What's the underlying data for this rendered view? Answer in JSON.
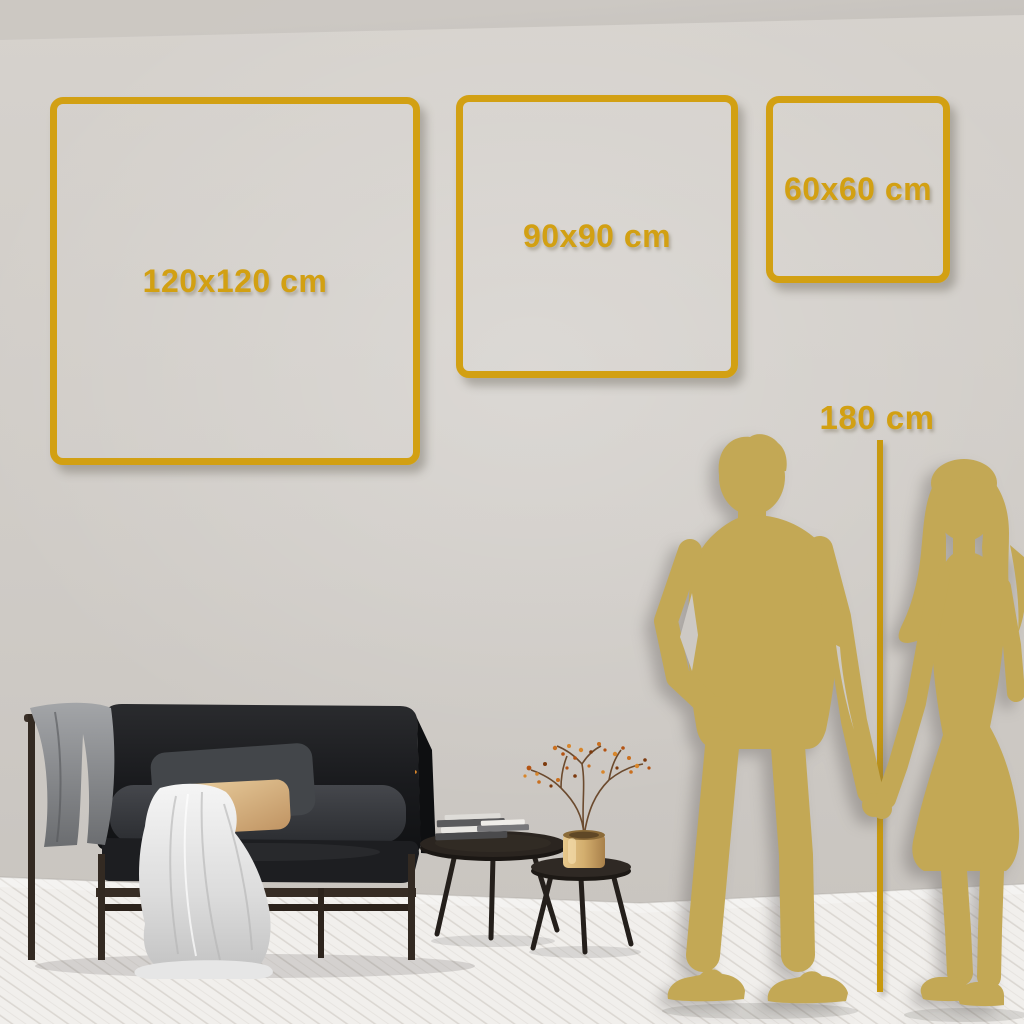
{
  "size_guide": {
    "frames": [
      {
        "label": "120x120 cm",
        "width_cm": 120,
        "height_cm": 120
      },
      {
        "label": "90x90 cm",
        "width_cm": 90,
        "height_cm": 90
      },
      {
        "label": "60x60 cm",
        "width_cm": 60,
        "height_cm": 60
      }
    ],
    "person_height": {
      "label": "180 cm",
      "height_cm": 180
    }
  },
  "colors": {
    "accent_gold": "#D2A013",
    "accent_gold_dark": "#C8990F",
    "silhouette_gold": "#C3A855",
    "wall_light": "#D6D2CD",
    "wall_dark": "#C7C3BE",
    "floor_base": "#F1EFEC",
    "floor_line": "#DBD7D2"
  },
  "scene": {
    "objects": [
      "gold-frame-120",
      "gold-frame-90",
      "gold-frame-60",
      "height-reference-line",
      "couple-silhouette",
      "sofa",
      "grey-blanket",
      "white-throw-blanket",
      "grey-pillow",
      "tan-pillow",
      "nesting-coffee-tables",
      "book-stacks",
      "brass-vase",
      "dried-branch-with-berries"
    ]
  }
}
